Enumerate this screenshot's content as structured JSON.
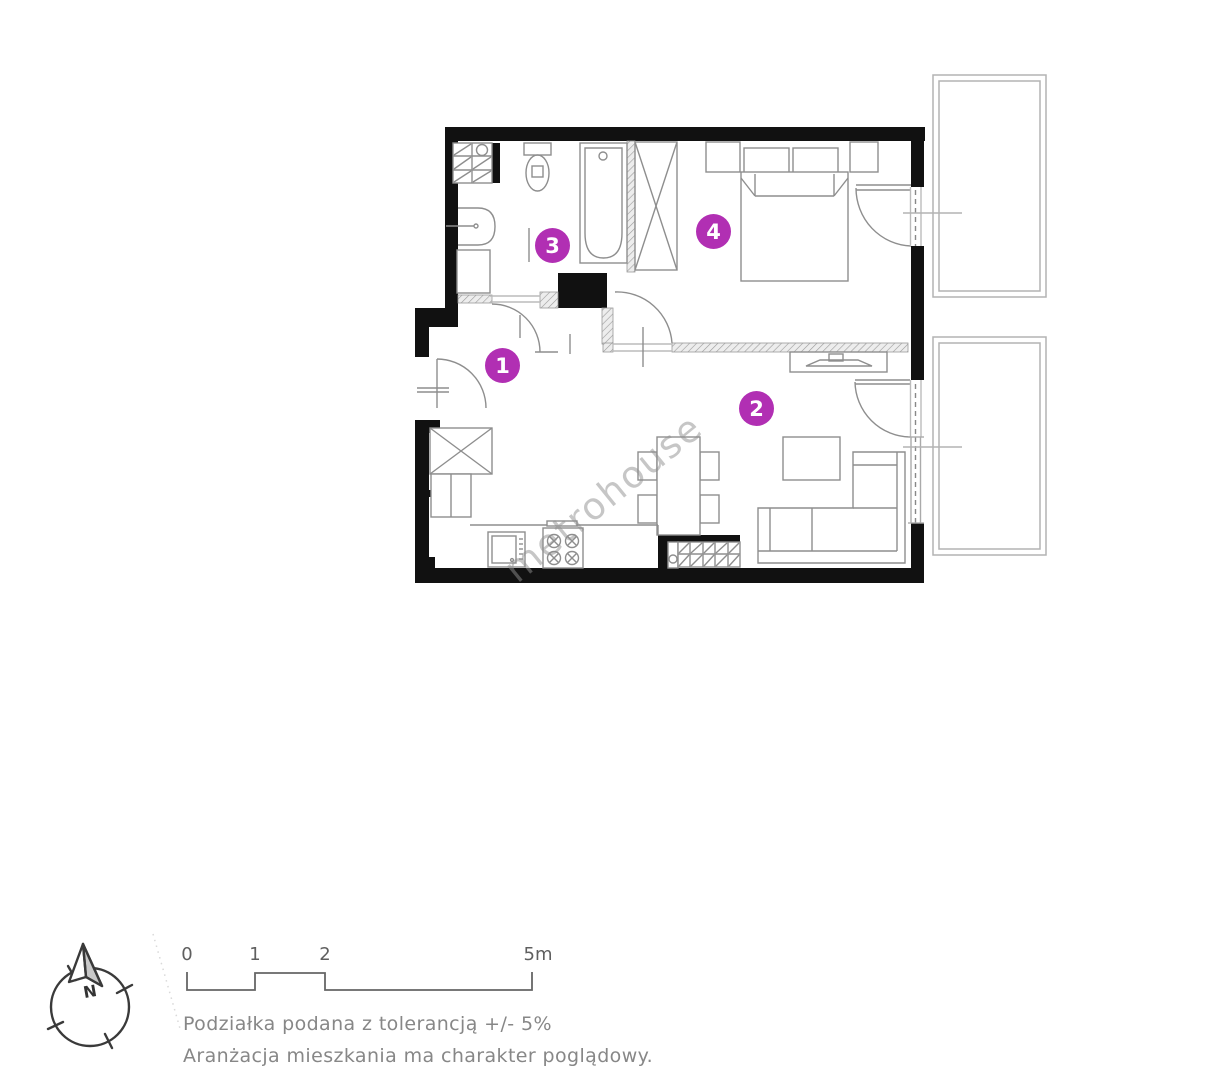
{
  "plan": {
    "watermark": "metrohouse",
    "accent_color": "#b12fb3",
    "wall_color": "#111111",
    "markers": [
      {
        "room": "hall",
        "label": "1"
      },
      {
        "room": "living-room",
        "label": "2"
      },
      {
        "room": "bathroom",
        "label": "3"
      },
      {
        "room": "bedroom",
        "label": "4"
      }
    ]
  },
  "compass": {
    "north_label": "N"
  },
  "scale_bar": {
    "labels": [
      "0",
      "1",
      "2",
      "5m"
    ]
  },
  "footnotes": [
    "Podziałka podana z tolerancją +/- 5%",
    "Aranżacja mieszkania ma charakter poglądowy."
  ]
}
